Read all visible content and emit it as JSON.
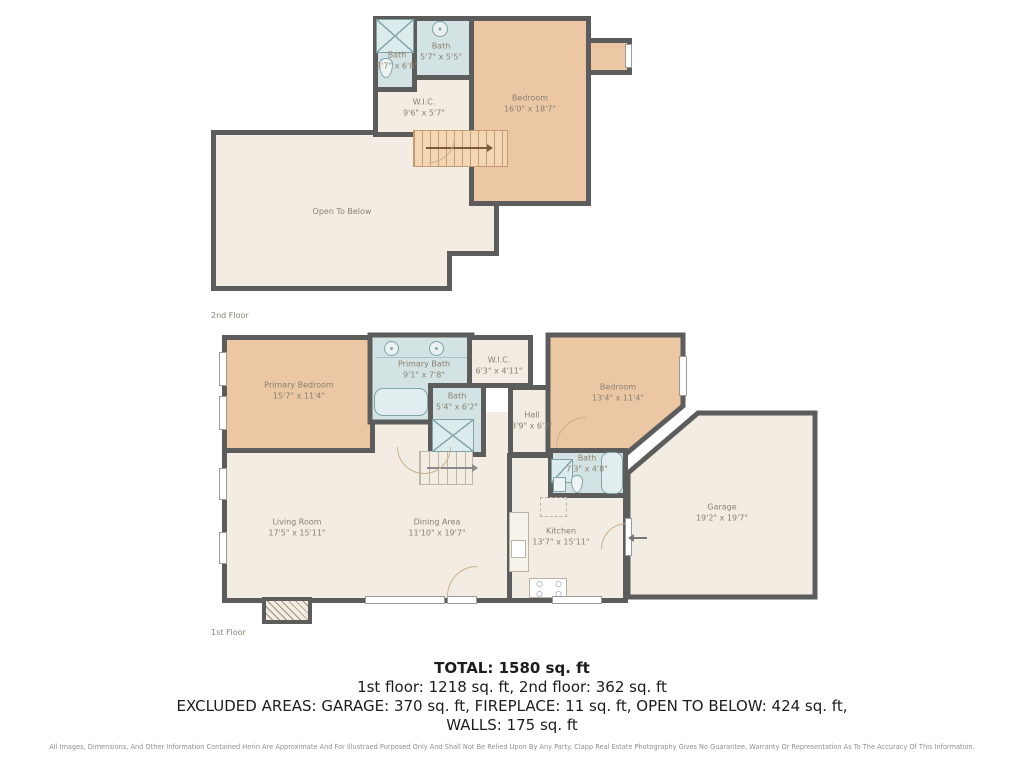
{
  "floors": {
    "second": {
      "label": "2nd Floor",
      "rooms": {
        "bath_a": {
          "name": "Bath",
          "dims": "3'7\" x 6'8\""
        },
        "bath_b": {
          "name": "Bath",
          "dims": "5'7\" x 5'5\""
        },
        "wic": {
          "name": "W.I.C.",
          "dims": "9'6\" x 5'7\""
        },
        "bedroom": {
          "name": "Bedroom",
          "dims": "16'0\" x 18'7\""
        },
        "open_to_below": {
          "name": "Open To Below",
          "dims": ""
        }
      }
    },
    "first": {
      "label": "1st Floor",
      "rooms": {
        "primary_bedroom": {
          "name": "Primary Bedroom",
          "dims": "15'7\" x 11'4\""
        },
        "primary_bath": {
          "name": "Primary Bath",
          "dims": "9'1\" x 7'8\""
        },
        "wic": {
          "name": "W.I.C.",
          "dims": "6'3\" x 4'11\""
        },
        "bedroom": {
          "name": "Bedroom",
          "dims": "13'4\" x 11'4\""
        },
        "bath_small": {
          "name": "Bath",
          "dims": "5'4\" x 6'2\""
        },
        "hall": {
          "name": "Hall",
          "dims": "3'9\" x 6'2\""
        },
        "bath": {
          "name": "Bath",
          "dims": "7'3\" x 4'8\""
        },
        "garage": {
          "name": "Garage",
          "dims": "19'2\" x 19'7\""
        },
        "living_room": {
          "name": "Living Room",
          "dims": "17'5\" x 15'11\""
        },
        "dining_area": {
          "name": "Dining Area",
          "dims": "11'10\" x 19'7\""
        },
        "kitchen": {
          "name": "Kitchen",
          "dims": "13'7\" x 15'11\""
        }
      }
    }
  },
  "summary": {
    "total": "TOTAL: 1580 sq. ft",
    "floors_line": "1st floor: 1218 sq. ft, 2nd floor: 362 sq. ft",
    "excluded_line": "EXCLUDED AREAS: GARAGE: 370 sq. ft, FIREPLACE: 11 sq. ft, OPEN TO BELOW: 424 sq. ft,",
    "walls_line": "WALLS: 175 sq. ft"
  },
  "disclaimer": "All Images, Dimensions, And Other Information Contained Herin Are Approximate And For Illustraed Purposed Only And Shall Not Be Relied Upon By Any Party. Clapp Real Estate Photography Gives No Guarantee, Warranty Or Representation As To The Accuracy Of This Information.",
  "colors": {
    "walls": "#5c5c5c",
    "floor_fill": "#f2ece2",
    "bedroom_fill": "#ebc7a4",
    "bath_fill": "#d3e3e4",
    "stairs_fill": "#f3d7b5",
    "room_label_text": "#8b8170",
    "summary_text": "#1c1c1c",
    "disclaimer_text": "#8f8f8f"
  }
}
